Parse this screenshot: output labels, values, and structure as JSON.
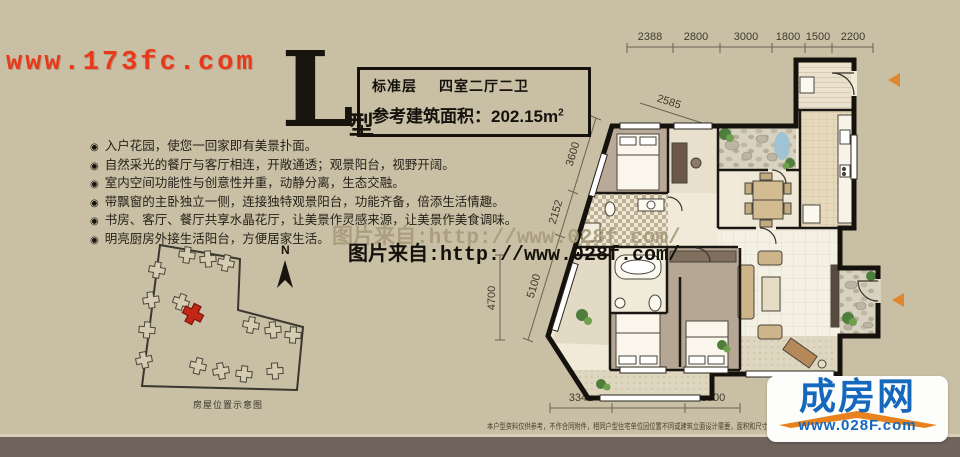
{
  "watermarks": {
    "agency_site": "www.173fc.com",
    "credit_light": "图片来自:http://www.028f.com/",
    "credit_dark": "图片来自:http://www.028f.com/"
  },
  "header": {
    "type_letter": "L",
    "type_suffix": "型",
    "floor_label": "标准层",
    "layout_label": "四室二厅二卫",
    "area_label": "参考建筑面积：",
    "area_value": "202.15",
    "area_unit_base": "m",
    "area_unit_sup": "2"
  },
  "icons": {
    "bullet": "◉",
    "north_label": "N"
  },
  "features": [
    "入户花园，使您一回家即有美景扑面。",
    "自然采光的餐厅与客厅相连，开敞通透；观景阳台，视野开阔。",
    "室内空间功能性与创意性并重，动静分离，生态交融。",
    "带飘窗的主卧独立一侧，连接独特观景阳台，功能齐备，倍添生活情趣。",
    "书房、客厅、餐厅共享水晶花厅，让美景作灵感来源，让美景作美食调味。",
    "明亮厨房外接生活阳台，方便居家生活。"
  ],
  "site_plan": {
    "caption": "房屋位置示意图"
  },
  "floor_plan": {
    "dims_top": [
      "2388",
      "2800",
      "3000",
      "1800",
      "1500",
      "2200"
    ],
    "dim_slant": "2585",
    "dims_left": [
      "3600",
      "2152",
      "5100"
    ],
    "dim_far_left": "4700",
    "dims_bottom": [
      "3341",
      "4200",
      "3000"
    ]
  },
  "footer": {
    "disclaimer": "本户型资料仅供参考，不作合同附件，相同户型住宅单位因位置不同或建筑立面设计需要，面积和尺寸略有差异。",
    "logo_name": "成房网",
    "logo_url": "www.028F.com"
  },
  "colors": {
    "background": "#c9bfa4",
    "footer_bar": "#6f635c",
    "agency_red": "#e8391c",
    "logo_blue": "#1668bd",
    "logo_orange": "#e8821e",
    "entry_arrow": "#e0862e",
    "highlight_building": "#c22718"
  }
}
